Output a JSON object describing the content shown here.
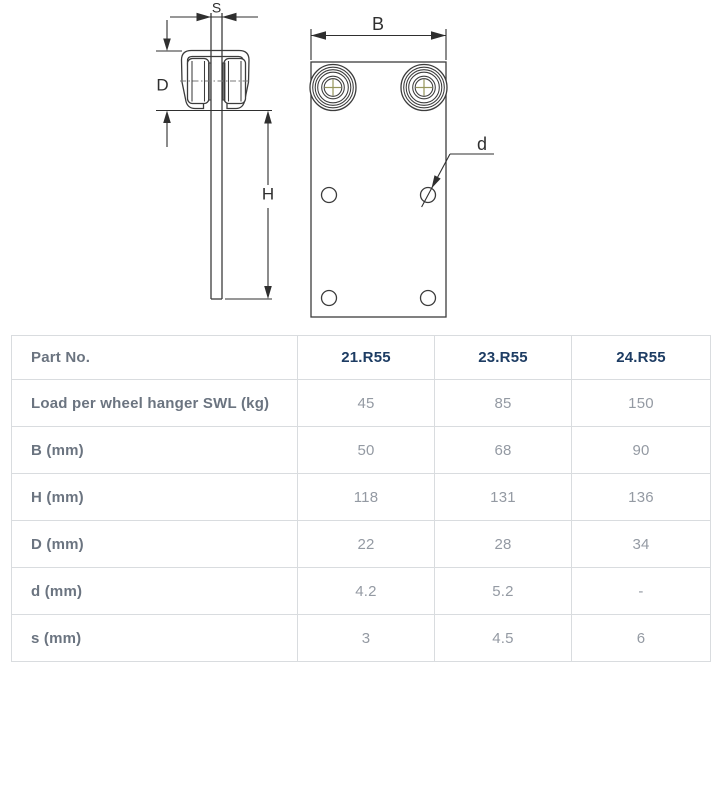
{
  "theme": {
    "line_dark": "#3c3c3c",
    "dim_dark": "#2f2f2f",
    "centerline_olive": "#97975c",
    "accent_navy": "#1d3c63",
    "label_gray": "#6b7480",
    "value_gray": "#949aa3",
    "border_gray": "#d9dcdf"
  },
  "diagram": {
    "labels": {
      "s": "S",
      "D": "D",
      "H": "H",
      "B": "B",
      "d": "d"
    }
  },
  "table": {
    "header": {
      "label": "Part No.",
      "columns": [
        "21.R55",
        "23.R55",
        "24.R55"
      ]
    },
    "rows": [
      {
        "label": "Load per wheel hanger SWL (kg)",
        "values": [
          "45",
          "85",
          "150"
        ]
      },
      {
        "label": "B (mm)",
        "values": [
          "50",
          "68",
          "90"
        ]
      },
      {
        "label": "H (mm)",
        "values": [
          "118",
          "131",
          "136"
        ]
      },
      {
        "label": "D (mm)",
        "values": [
          "22",
          "28",
          "34"
        ]
      },
      {
        "label": "d (mm)",
        "values": [
          "4.2",
          "5.2",
          "-"
        ]
      },
      {
        "label": "s (mm)",
        "values": [
          "3",
          "4.5",
          "6"
        ]
      }
    ]
  }
}
